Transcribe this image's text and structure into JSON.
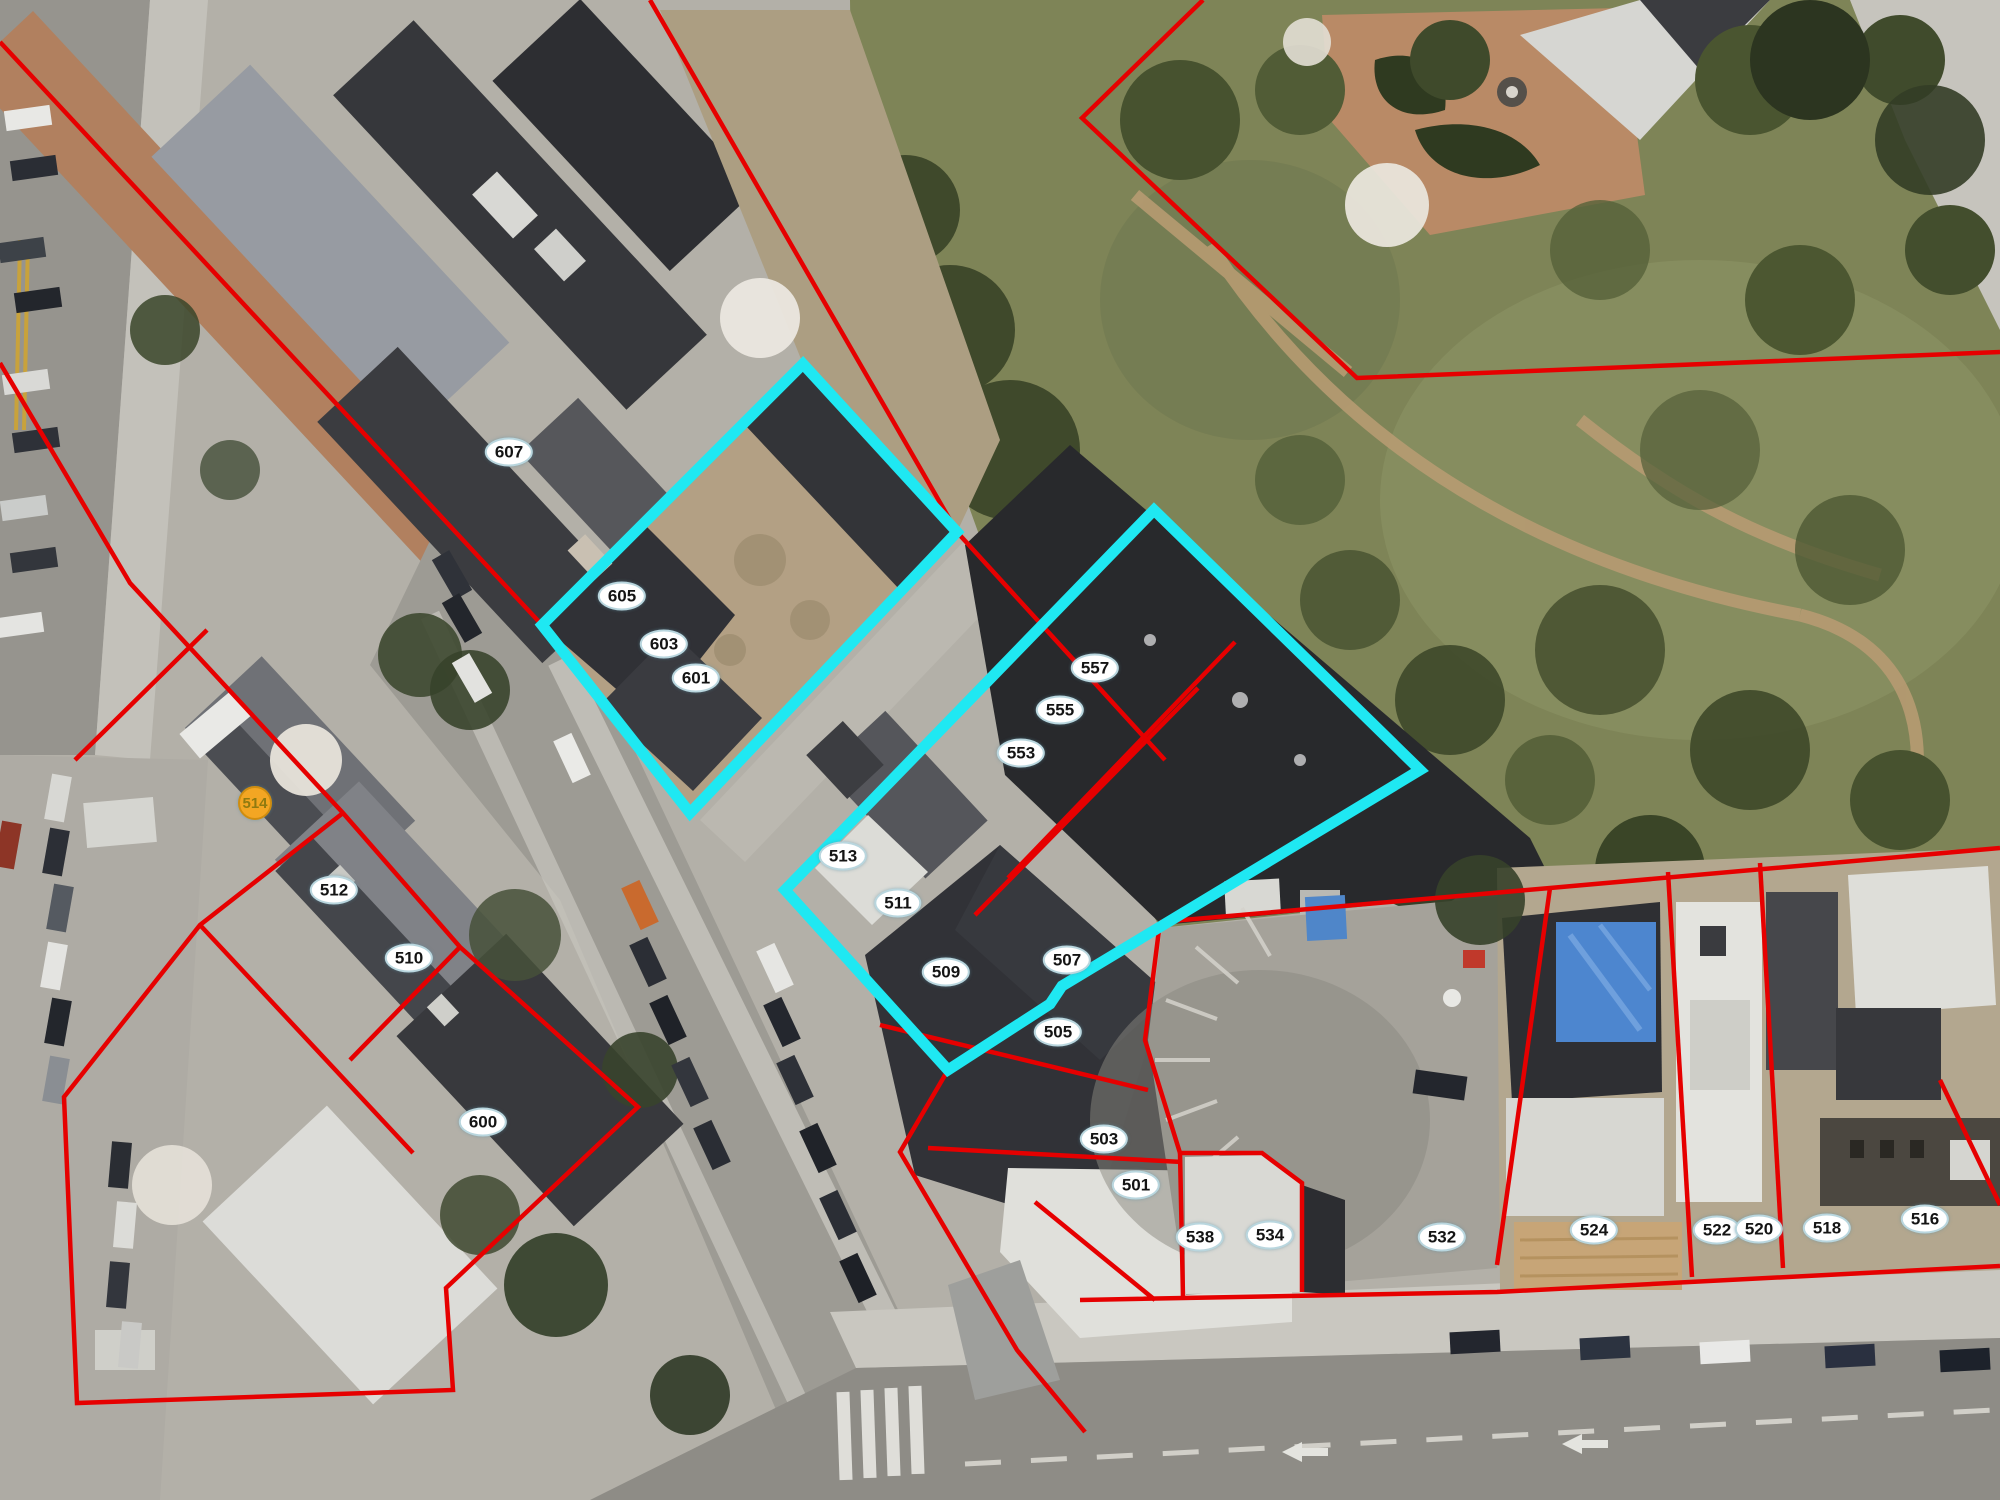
{
  "map": {
    "description": "Aerial parcel map with two cyan-highlighted selections",
    "parcel_line_color": "#e60000",
    "selection_color": "#1fe8f2",
    "label_bg": "#ffffff",
    "label_text_color": "#141414",
    "address_point_color": "#f3a623",
    "address_point_text_color": "#8f7a10"
  },
  "selection": {
    "highlighted_parcel_ids": [
      "601",
      "603",
      "605",
      "509",
      "511",
      "513",
      "553",
      "555",
      "557"
    ]
  },
  "parcels": [
    {
      "id": "607",
      "x": 509,
      "y": 452,
      "type": "parcel"
    },
    {
      "id": "605",
      "x": 622,
      "y": 596,
      "type": "parcel"
    },
    {
      "id": "603",
      "x": 664,
      "y": 644,
      "type": "parcel"
    },
    {
      "id": "601",
      "x": 696,
      "y": 678,
      "type": "parcel"
    },
    {
      "id": "557",
      "x": 1095,
      "y": 668,
      "type": "parcel"
    },
    {
      "id": "555",
      "x": 1060,
      "y": 710,
      "type": "parcel"
    },
    {
      "id": "553",
      "x": 1021,
      "y": 753,
      "type": "parcel"
    },
    {
      "id": "513",
      "x": 843,
      "y": 856,
      "type": "parcel"
    },
    {
      "id": "511",
      "x": 898,
      "y": 903,
      "type": "parcel"
    },
    {
      "id": "509",
      "x": 946,
      "y": 972,
      "type": "parcel"
    },
    {
      "id": "507",
      "x": 1067,
      "y": 960,
      "type": "parcel"
    },
    {
      "id": "505",
      "x": 1058,
      "y": 1032,
      "type": "parcel"
    },
    {
      "id": "503",
      "x": 1104,
      "y": 1139,
      "type": "parcel"
    },
    {
      "id": "501",
      "x": 1136,
      "y": 1185,
      "type": "parcel"
    },
    {
      "id": "514",
      "x": 255,
      "y": 803,
      "type": "address-point"
    },
    {
      "id": "512",
      "x": 334,
      "y": 890,
      "type": "parcel"
    },
    {
      "id": "510",
      "x": 409,
      "y": 958,
      "type": "parcel"
    },
    {
      "id": "600",
      "x": 483,
      "y": 1122,
      "type": "parcel"
    },
    {
      "id": "538",
      "x": 1200,
      "y": 1237,
      "type": "parcel"
    },
    {
      "id": "534",
      "x": 1270,
      "y": 1235,
      "type": "parcel"
    },
    {
      "id": "532",
      "x": 1442,
      "y": 1237,
      "type": "parcel"
    },
    {
      "id": "524",
      "x": 1594,
      "y": 1230,
      "type": "parcel"
    },
    {
      "id": "522",
      "x": 1717,
      "y": 1230,
      "type": "parcel"
    },
    {
      "id": "520",
      "x": 1759,
      "y": 1229,
      "type": "parcel"
    },
    {
      "id": "518",
      "x": 1827,
      "y": 1228,
      "type": "parcel"
    },
    {
      "id": "516",
      "x": 1925,
      "y": 1219,
      "type": "parcel"
    }
  ]
}
